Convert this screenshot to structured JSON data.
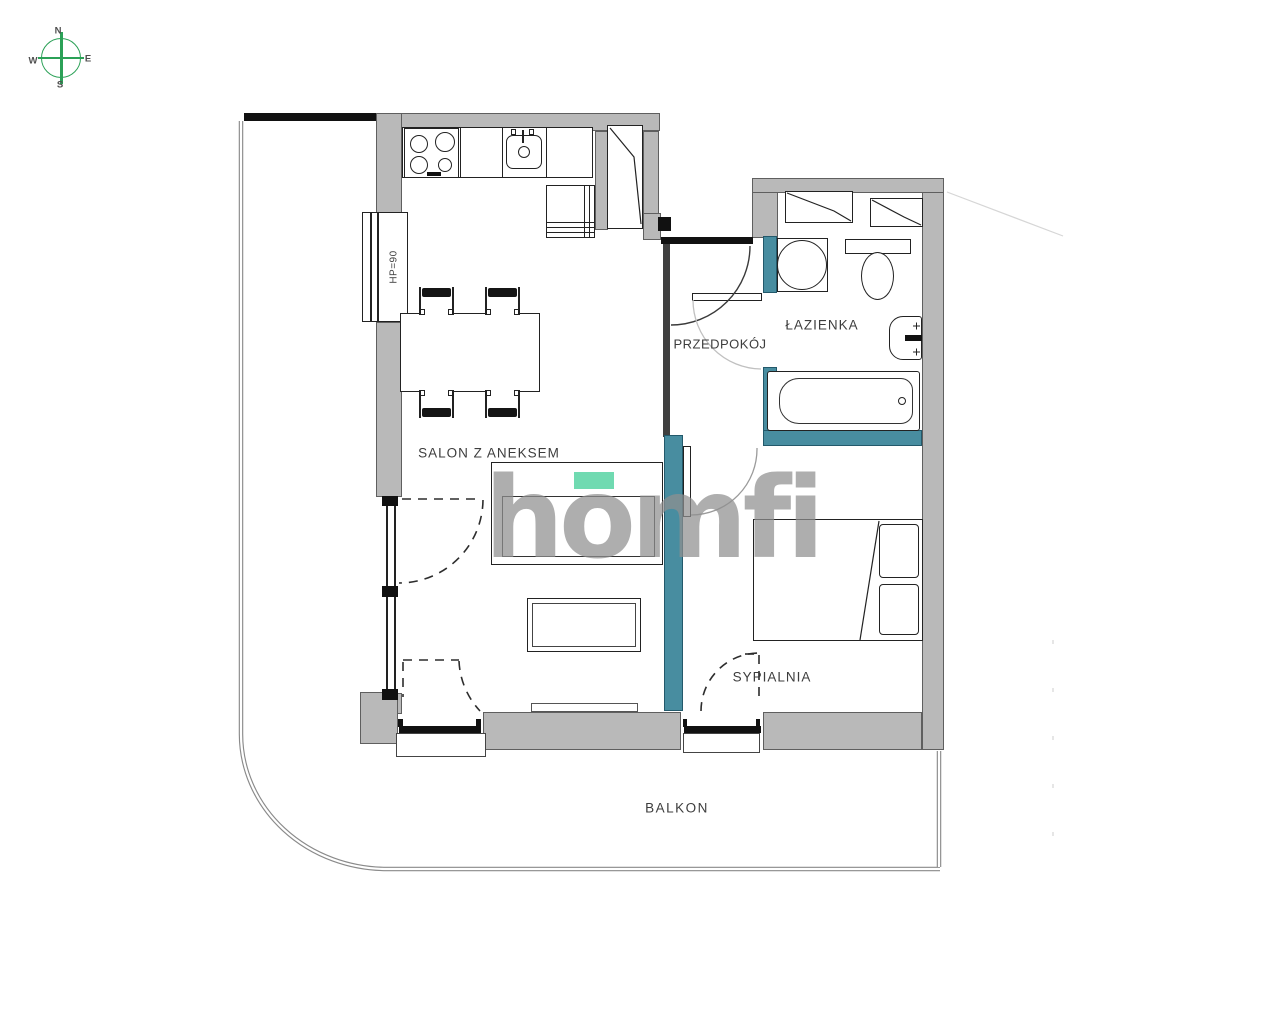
{
  "plan": {
    "rooms": [
      {
        "id": "living",
        "label": "SALON Z ANEKSEM"
      },
      {
        "id": "hallway",
        "label": "PRZEDPOKÓJ"
      },
      {
        "id": "bathroom",
        "label": "ŁAZIENKA"
      },
      {
        "id": "bedroom",
        "label": "SYPIALNIA"
      },
      {
        "id": "balcony",
        "label": "BALKON"
      }
    ],
    "window_annotation": "HP=90"
  },
  "compass": {
    "n": "N",
    "e": "E",
    "s": "S",
    "w": "W"
  },
  "watermark": {
    "text": "homfi"
  },
  "colors": {
    "wall_gray": "#b9b9b9",
    "wet_wall_teal": "#488da0",
    "compass_green": "#2ba157",
    "watermark_gray": "#909090",
    "watermark_accent_green": "#57d3a3",
    "outline_dark": "#222222"
  }
}
